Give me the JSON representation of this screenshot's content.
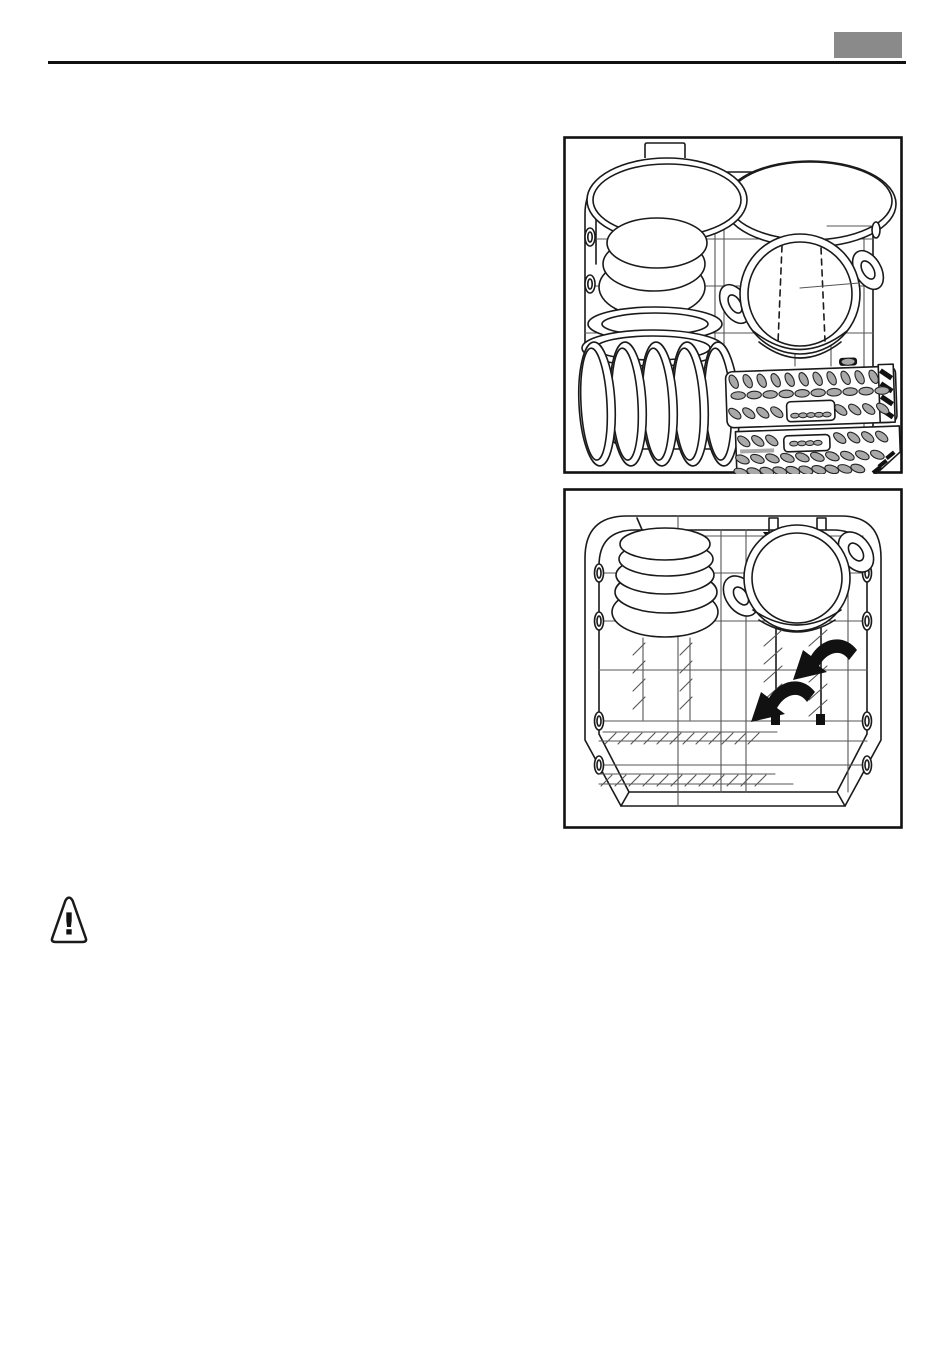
{
  "page": {
    "background": "#ffffff",
    "width": 950,
    "height": 1355
  },
  "header": {
    "rule_color": "#111111",
    "page_tab": {
      "color": "#8a8a8a",
      "text": ""
    }
  },
  "figures": [
    {
      "id": "upper-basket-diagram",
      "description": "Dishwasher basket loaded with a lid, stacked bowls, oval platters, upright plates, a pot and a cutlery basket"
    },
    {
      "id": "lower-basket-diagram",
      "description": "Dishwasher lower basket with stacked bowls, an upturned pot and arrows showing the plate racks folding down"
    }
  ],
  "warning": {
    "icon": "warning-triangle-icon",
    "glyph": "!"
  },
  "colors": {
    "line": "#1a1a1a",
    "grid": "#555555",
    "slot_gray": "#a9a9a9",
    "tab_gray": "#8a8a8a"
  }
}
